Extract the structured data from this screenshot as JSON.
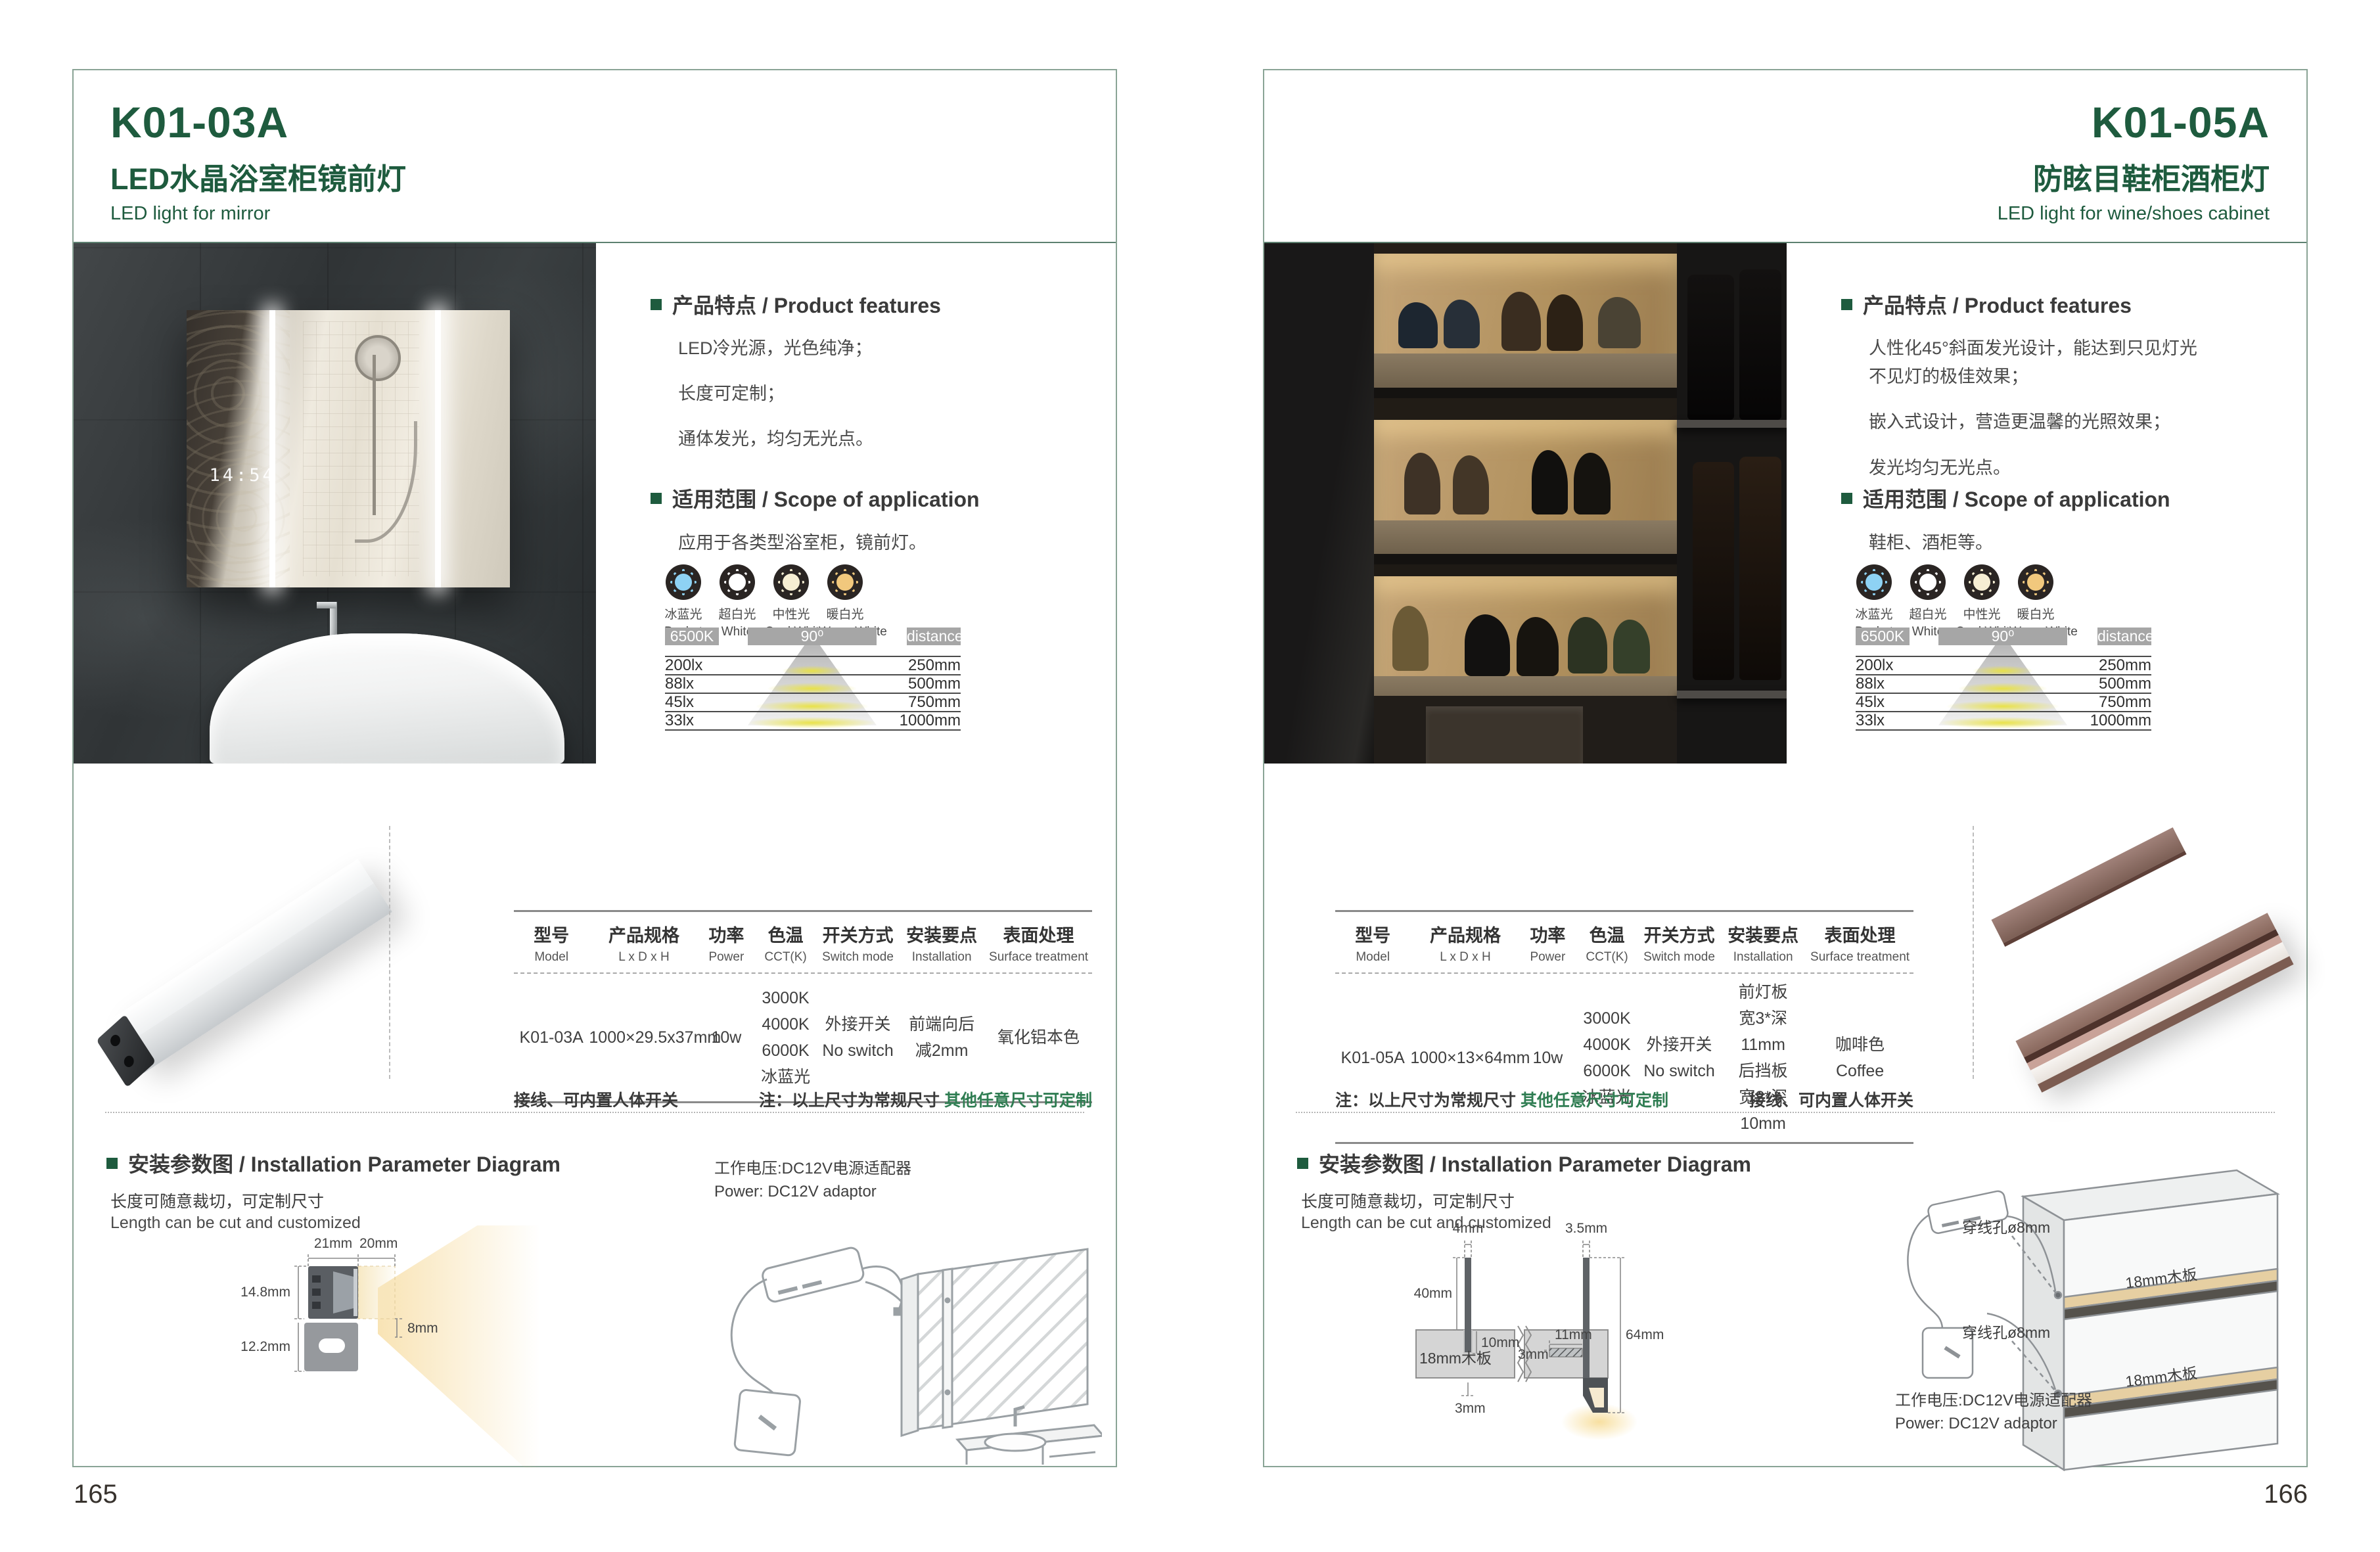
{
  "colors": {
    "brand_green": "#1e5b3e",
    "note_green": "#2f7d52",
    "panel_border": "#8aa496",
    "bar_gray": "#a6a6a6",
    "coffee_brown": "#8a695e"
  },
  "shared": {
    "features_heading": "产品特点 / Product features",
    "scope_heading": "适用范围 / Scope of application",
    "install_heading": "安装参数图 / Installation Parameter Diagram",
    "install_line_cn": "长度可随意裁切，可定制尺寸",
    "install_line_en": "Length can be cut and customized",
    "power_label": "工作电压:DC12V电源适配器\nPower: DC12V adaptor",
    "icons": [
      {
        "cn": "冰蓝光",
        "en": "Basket",
        "color": "#8ed2f4"
      },
      {
        "cn": "超白光",
        "en": "White",
        "color": "#ffffff"
      },
      {
        "cn": "中性光",
        "en": "Cool White",
        "color": "#f6eed3"
      },
      {
        "cn": "暖白光",
        "en": "Warm White",
        "color": "#f1c87d"
      }
    ],
    "chart": {
      "cct": "6500K",
      "angle": "90⁰",
      "distance": "distance",
      "rows": [
        {
          "lx": "200lx",
          "mm": "250mm"
        },
        {
          "lx": "88lx",
          "mm": "500mm"
        },
        {
          "lx": "45lx",
          "mm": "750mm"
        },
        {
          "lx": "33lx",
          "mm": "1000mm"
        }
      ]
    },
    "table_headers": [
      {
        "cn": "型号",
        "en": "Model"
      },
      {
        "cn": "产品规格",
        "en": "L x D x H"
      },
      {
        "cn": "功率",
        "en": "Power"
      },
      {
        "cn": "色温",
        "en": "CCT(K)"
      },
      {
        "cn": "开关方式",
        "en": "Switch mode"
      },
      {
        "cn": "安装要点",
        "en": "Installation"
      },
      {
        "cn": "表面处理",
        "en": "Surface treatment"
      }
    ],
    "note_wiring": "接线、可内置人体开关",
    "note_prefix": "注：以上尺寸为常规尺寸 ",
    "note_custom": "其他任意尺寸可定制"
  },
  "page_left": {
    "page_number": "165",
    "model": "K01-03A",
    "title_cn": "LED水晶浴室柜镜前灯",
    "title_en": "LED light for mirror",
    "features": [
      "LED冷光源，光色纯净；",
      "长度可定制；",
      "通体发光，均匀无光点。"
    ],
    "scope": "应用于各类型浴室柜，镜前灯。",
    "mirror_clock": "14:54",
    "table": {
      "model": "K01-03A",
      "size": "1000×29.5x37mm",
      "power": "10w",
      "cct": "3000K\n4000K\n6000K\n冰蓝光",
      "switch": "外接开关\nNo switch",
      "install": "前端向后\n减2mm",
      "surface": "氧化铝本色"
    },
    "dims": {
      "d21": "21mm",
      "d20": "20mm",
      "d148": "14.8mm",
      "d122": "12.2mm",
      "d8": "8mm"
    }
  },
  "page_right": {
    "page_number": "166",
    "model": "K01-05A",
    "title_cn": "防眩目鞋柜酒柜灯",
    "title_en": "LED light for wine/shoes cabinet",
    "features": [
      "人性化45°斜面发光设计，能达到只见灯光\n不见灯的极佳效果；",
      "嵌入式设计，营造更温馨的光照效果；",
      "发光均匀无光点。"
    ],
    "scope": "鞋柜、酒柜等。",
    "table": {
      "model": "K01-05A",
      "size": "1000×13×64mm",
      "power": "10w",
      "cct": "3000K\n4000K\n6000K\n冰蓝光",
      "switch": "外接开关\nNo switch",
      "install": "前灯板\n宽3*深11mm\n后挡板\n宽3*深10mm",
      "surface": "咖啡色\nCoffee"
    },
    "dims": {
      "d4": "4mm",
      "d35": "3.5mm",
      "d40": "40mm",
      "d10": "10mm",
      "d11": "11mm",
      "d64": "64mm",
      "d3a": "3mm",
      "d3b": "3mm",
      "board": "18mm木板"
    },
    "hole_label": "穿线孔ø8mm",
    "shelf_label": "18mm木板"
  }
}
